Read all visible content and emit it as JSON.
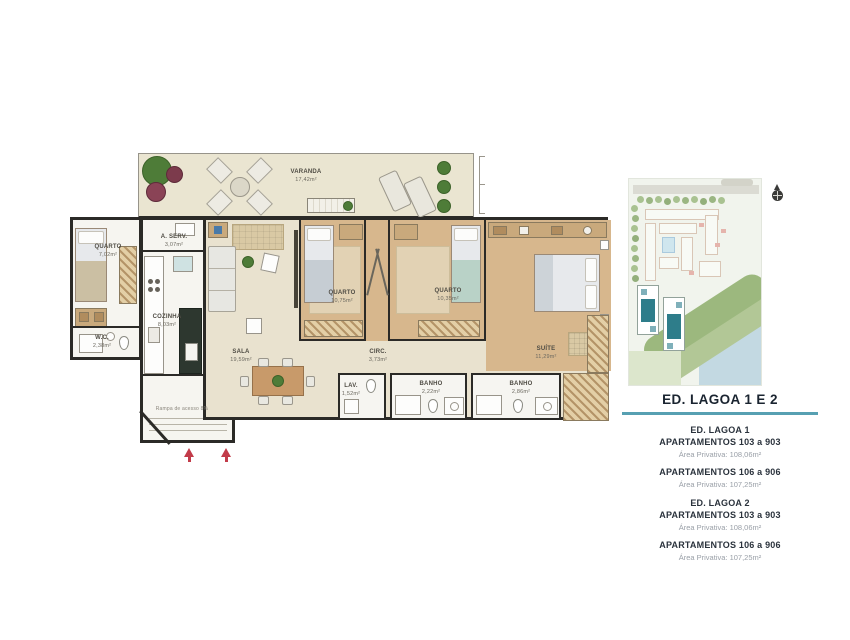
{
  "plan": {
    "rooms": {
      "varanda": {
        "name": "VARANDA",
        "area": "17,42m²"
      },
      "quarto1": {
        "name": "QUARTO",
        "area": "7,02m²"
      },
      "wc": {
        "name": "W.C.",
        "area": "2,38m²"
      },
      "aserv": {
        "name": "A. SERV.",
        "area": "3,07m²"
      },
      "cozinha": {
        "name": "COZINHA",
        "area": "8,03m²"
      },
      "sala": {
        "name": "SALA",
        "area": "19,59m²"
      },
      "quarto2": {
        "name": "QUARTO",
        "area": "10,75m²"
      },
      "quarto3": {
        "name": "QUARTO",
        "area": "10,35m²"
      },
      "suite": {
        "name": "SUÍTE",
        "area": "11,29m²"
      },
      "circ": {
        "name": "CIRC.",
        "area": "3,73m²"
      },
      "lav": {
        "name": "LAV.",
        "area": "1,52m²"
      },
      "banho1": {
        "name": "BANHO",
        "area": "2,22m²"
      },
      "banho2": {
        "name": "BANHO",
        "area": "2,86m²"
      }
    },
    "ramp_note": "Rampa de acesso 8%"
  },
  "panel": {
    "title": "ED. LAGOA 1 E 2",
    "blocks": [
      {
        "heading": "ED. LAGOA 1",
        "entries": [
          {
            "apartments": "APARTAMENTOS 103 a 903",
            "area": "Área Privativa: 108,06m²"
          },
          {
            "apartments": "APARTAMENTOS 106 a 906",
            "area": "Área Privativa: 107,25m²"
          }
        ]
      },
      {
        "heading": "ED. LAGOA 2",
        "entries": [
          {
            "apartments": "APARTAMENTOS 103 a 903",
            "area": "Área Privativa: 108,06m²"
          },
          {
            "apartments": "APARTAMENTOS 106 a 906",
            "area": "Área Privativa: 107,25m²"
          }
        ]
      }
    ]
  },
  "colors": {
    "accent_rule": "#57a0b2",
    "highlighted_building": "#2e7d8a",
    "entry_arrow": "#c23b49",
    "wood_floor": "#d7b78d",
    "wall": "#2b2a27"
  }
}
